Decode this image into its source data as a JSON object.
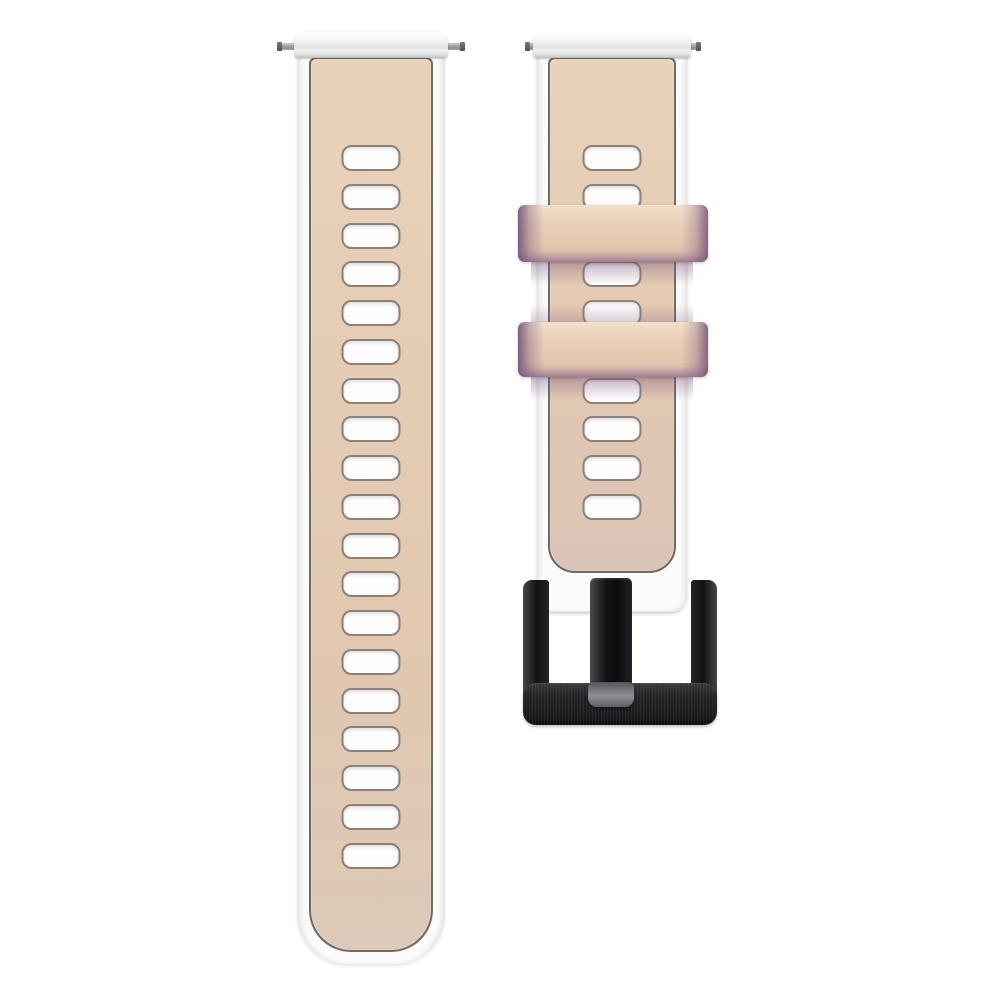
{
  "scene": {
    "type": "product-photo",
    "subject": "Two-piece silicone watch band shown flat on white: long adjustment strap (left) and buckle strap (right)",
    "background": "#ffffff"
  },
  "long_strap": {
    "adjustment_holes": 19,
    "spring_bar_pins": 2,
    "edge_color_name": "white",
    "face_color_name": "beige"
  },
  "buckle_strap": {
    "adjustment_holes_total": 10,
    "adjustment_holes_visible": 8,
    "spring_bar_pins": 2,
    "keeper_loops": 2,
    "keeper_edge_color_name": "lilac-purple",
    "buckle_type": "pin buckle",
    "buckle_finish": "brushed black"
  },
  "palette": {
    "bg": "#ffffff",
    "white_strap": "#fbfbfb",
    "beige_top": "#e9d2bb",
    "beige_mid": "#e3c9b1",
    "beige_bottom": "#dcc9b9",
    "panel_border": "#6e6a66",
    "hole_fill": "#fdfdfd",
    "hole_border": "#8d8177",
    "keeper_beige": "#e8cfb7",
    "keeper_purple": "#76547a",
    "buckle_black": "#131315",
    "tongue_tip_gray": "#8f8f94",
    "pin_gray": "#a5a5a5"
  },
  "hole_layout": {
    "first_top": 86,
    "pitch": 38.75,
    "width": 59,
    "height": 26
  }
}
